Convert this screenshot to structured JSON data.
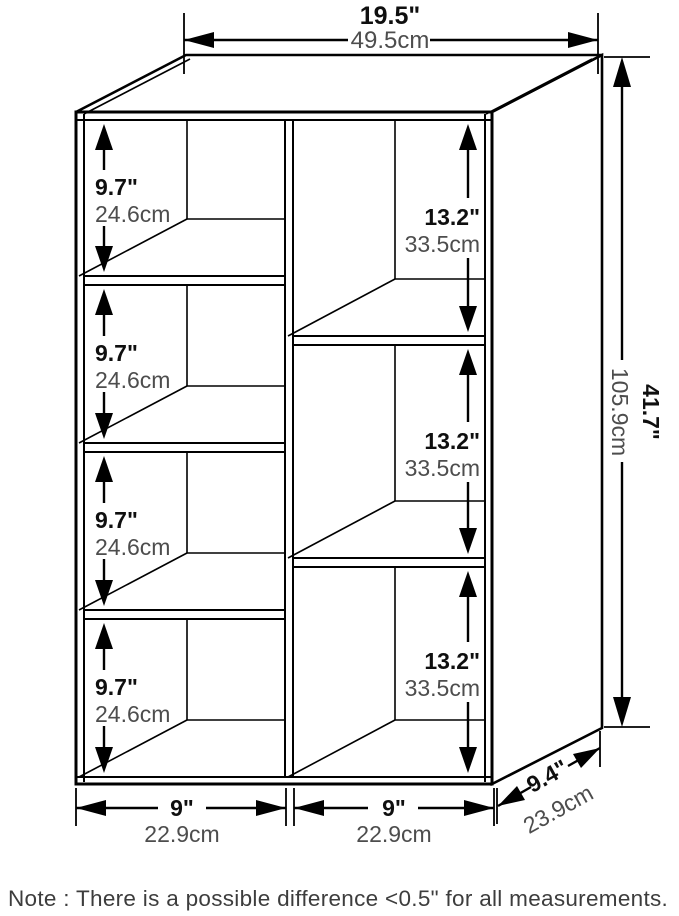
{
  "figure": {
    "width": {
      "inches": "19.5\"",
      "cm": "49.5cm"
    },
    "height": {
      "inches": "41.7\"",
      "cm": "105.9cm"
    },
    "depth": {
      "inches": "9.4\"",
      "cm": "23.9cm"
    },
    "left_compartments": [
      {
        "inches": "9.7\"",
        "cm": "24.6cm"
      },
      {
        "inches": "9.7\"",
        "cm": "24.6cm"
      },
      {
        "inches": "9.7\"",
        "cm": "24.6cm"
      },
      {
        "inches": "9.7\"",
        "cm": "24.6cm"
      }
    ],
    "right_compartments": [
      {
        "inches": "13.2\"",
        "cm": "33.5cm"
      },
      {
        "inches": "13.2\"",
        "cm": "33.5cm"
      },
      {
        "inches": "13.2\"",
        "cm": "33.5cm"
      }
    ],
    "bottom_widths": [
      {
        "inches": "9\"",
        "cm": "22.9cm"
      },
      {
        "inches": "9\"",
        "cm": "22.9cm"
      }
    ],
    "note": "Note : There is a possible difference <0.5\" for all measurements.",
    "colors": {
      "line": "#000000",
      "inch_text": "#0f0f0f",
      "cm_text": "#4d4d4d",
      "background": "#ffffff"
    }
  }
}
